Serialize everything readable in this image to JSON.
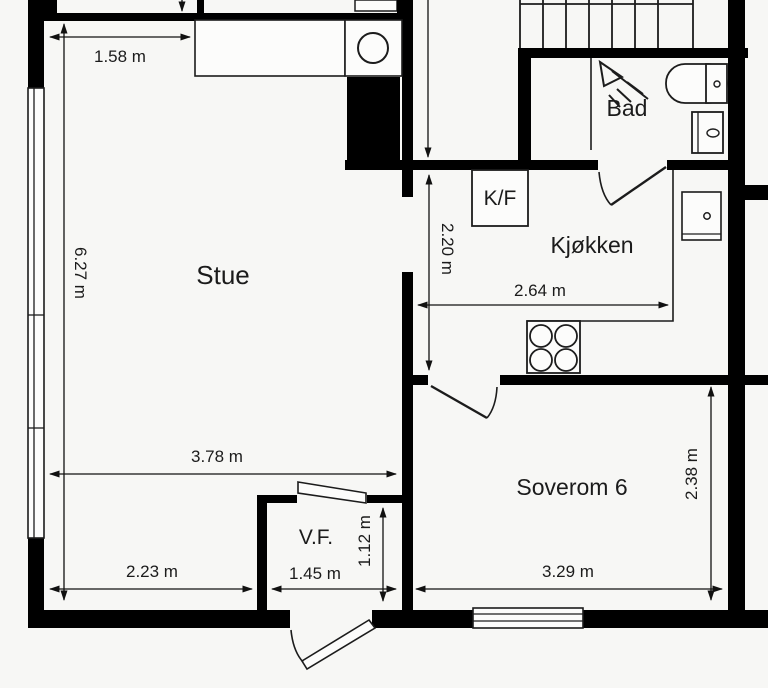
{
  "meta": {
    "type": "architectural-floor-plan"
  },
  "rooms": {
    "stue": {
      "label": "Stue"
    },
    "kjokken": {
      "label": "Kjøkken"
    },
    "bad": {
      "label": "Bad"
    },
    "soverom6": {
      "label": "Soverom 6"
    },
    "vf": {
      "label": "V.F."
    }
  },
  "appliances": {
    "fridge_freezer": {
      "label": "K/F"
    }
  },
  "dimensions": {
    "stue_top_width": "1.58 m",
    "stue_height": "6.27 m",
    "corridor_height": "2.20 m",
    "kjokken_width": "2.64 m",
    "stue_width": "3.78 m",
    "stue_bottom_width": "2.23 m",
    "vf_width": "1.45 m",
    "vf_height": "1.12 m",
    "soverom_width": "3.29 m",
    "soverom_height": "2.38 m"
  },
  "colors": {
    "wall": "#000000",
    "paper": "#f7f7f5",
    "line": "#1c1c1c"
  }
}
